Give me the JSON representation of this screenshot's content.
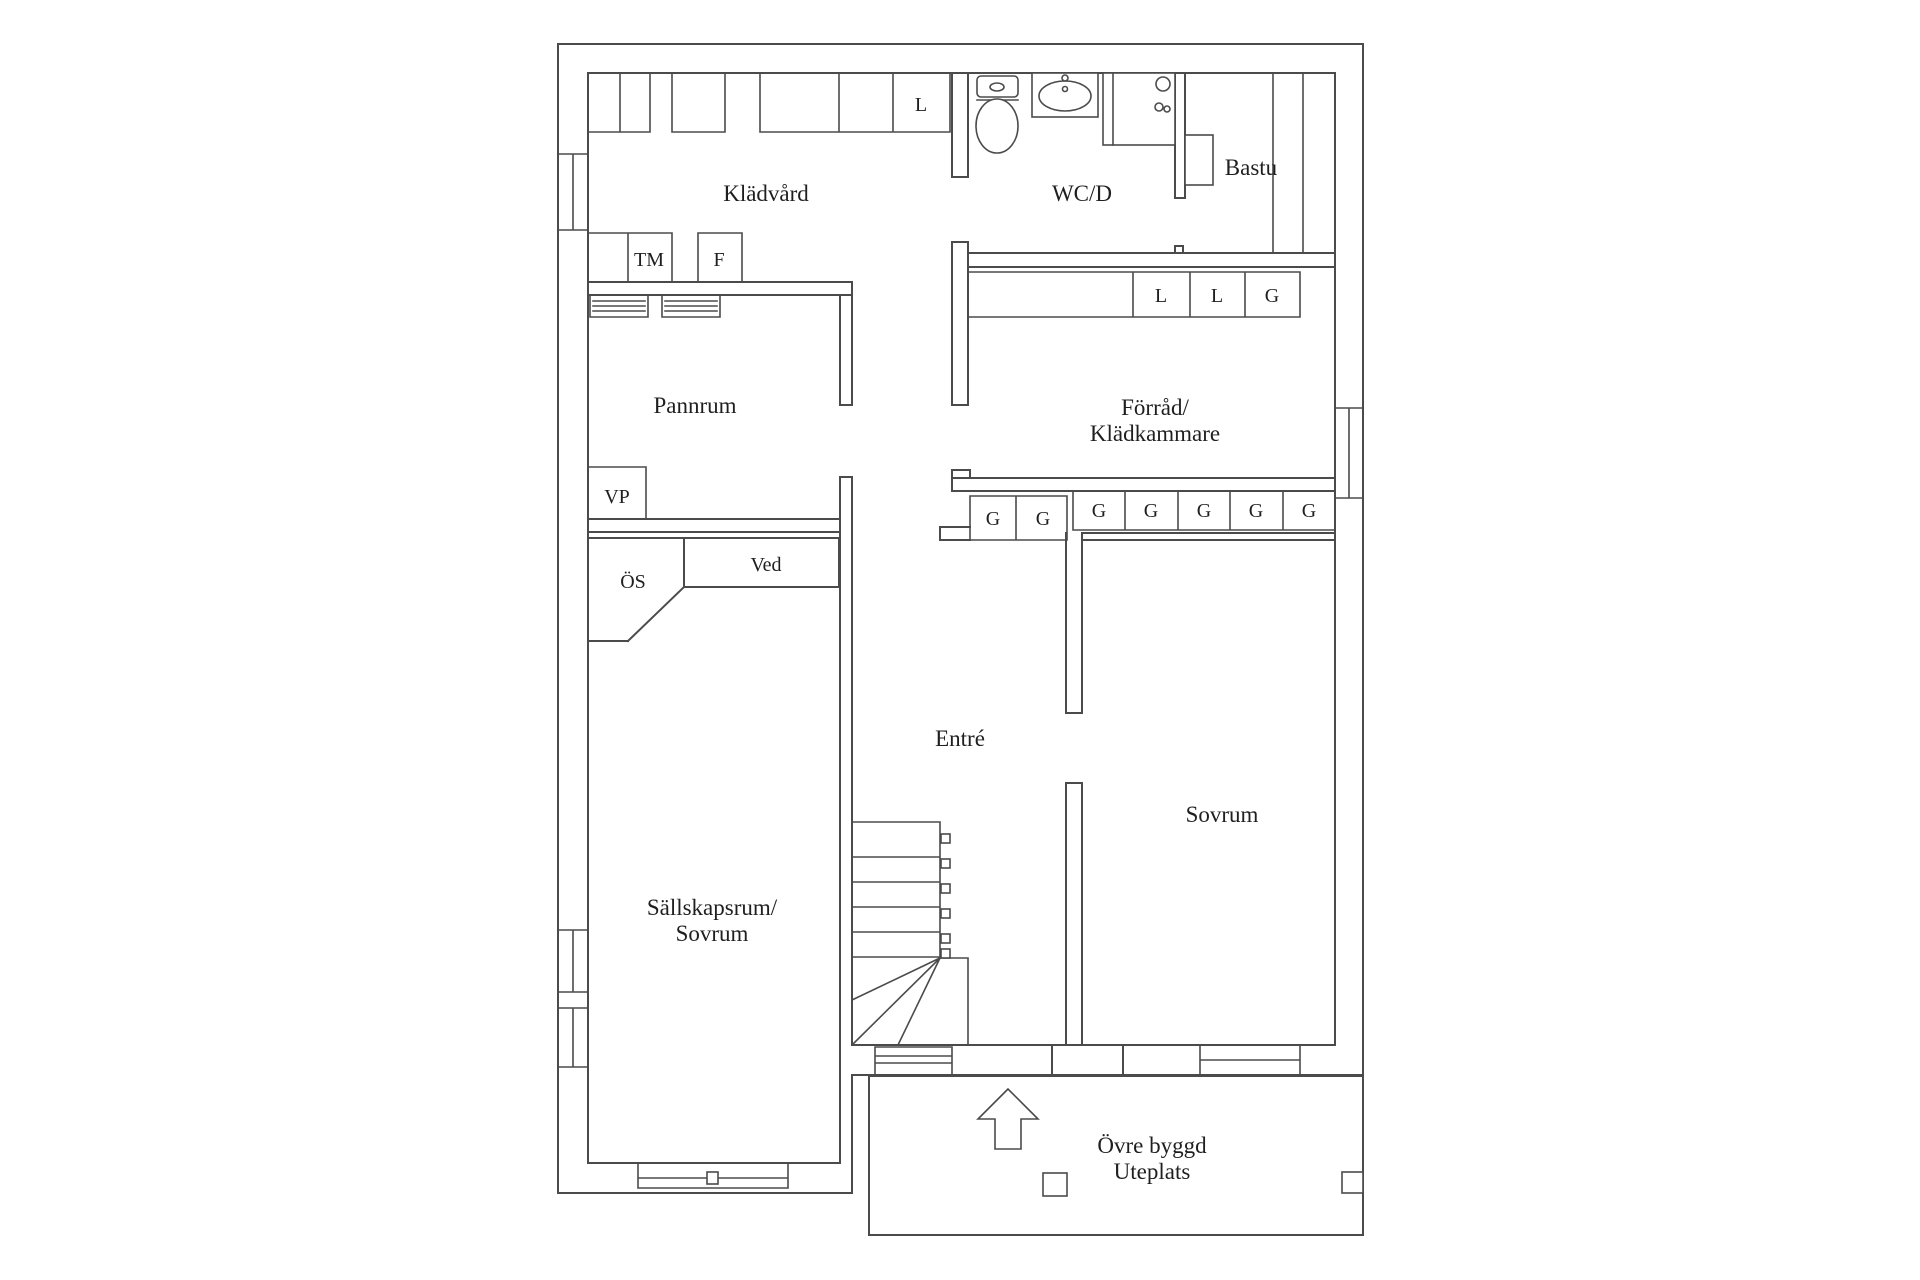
{
  "colors": {
    "line": "#4b4b4b",
    "text": "#1f1f1f",
    "background": "#ffffff"
  },
  "rooms": {
    "laundry": "Klädvård",
    "wc": "WC/D",
    "sauna": "Bastu",
    "boiler": "Pannrum",
    "storage_line1": "Förråd/",
    "storage_line2": "Klädkammare",
    "entry": "Entré",
    "bedroom": "Sovrum",
    "lounge_line1": "Sällskapsrum/",
    "lounge_line2": "Sovrum",
    "terrace_line1": "Övre byggd",
    "terrace_line2": "Uteplats"
  },
  "units": {
    "washer": "TM",
    "freezer": "F",
    "heat_pump": "VP",
    "flue": "ÖS",
    "wood": "Ved",
    "linen_closet": "L",
    "wardrobe": "G"
  }
}
